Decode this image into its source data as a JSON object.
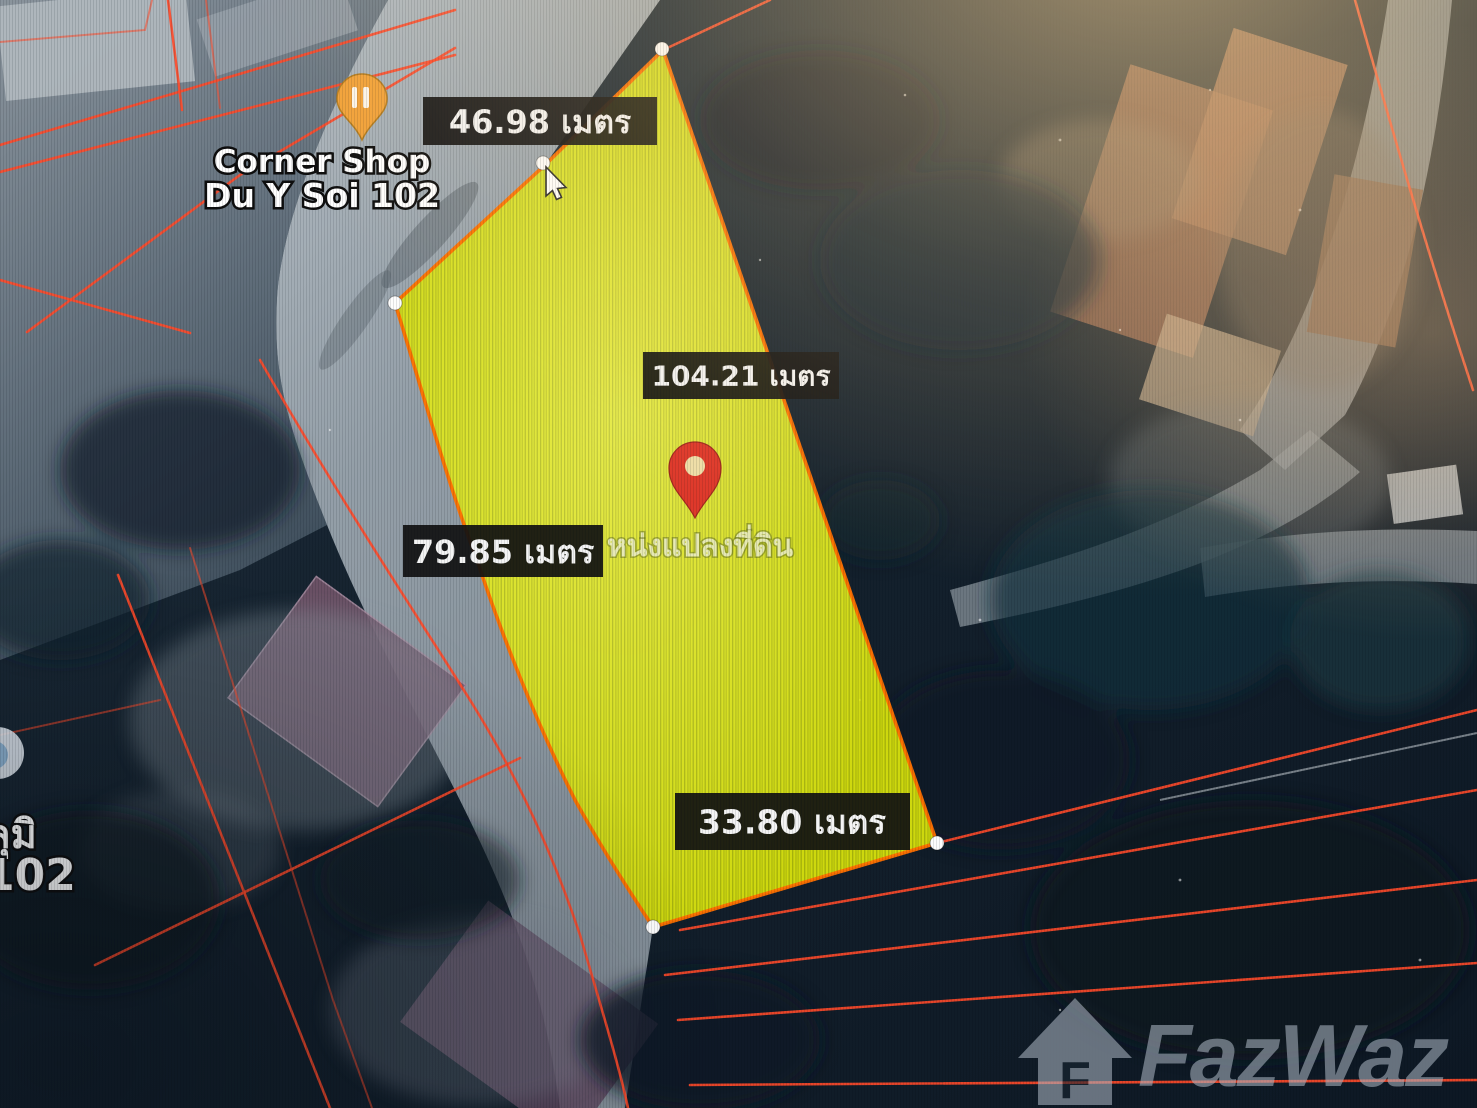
{
  "map": {
    "measurements": {
      "top": "46.98 เมตร",
      "right": "104.21 เมตร",
      "left": "79.85 เมตร",
      "bottom": "33.80 เมตร"
    },
    "poi": {
      "line1": "Corner Shop",
      "line2": "Du Y Soi 102"
    },
    "plot_caption": "หน่งแปลงที่ดิน",
    "edge_label": {
      "line1": "ลุมิ",
      "line2": "102"
    },
    "watermark": {
      "text": "FazWaz",
      "icon_letter": "F"
    },
    "colors": {
      "parcel_line": "#ff4a2a",
      "plot_fill": "#dfe90c",
      "plot_border": "#ff7000",
      "label_bg": "#121212",
      "label_text": "#f4f4f4",
      "pin": "#df392b",
      "poi_pin": "#f2a33b",
      "watermark": "#a9b3bf",
      "road": "#a7b0b8",
      "base": "#16222e"
    }
  }
}
